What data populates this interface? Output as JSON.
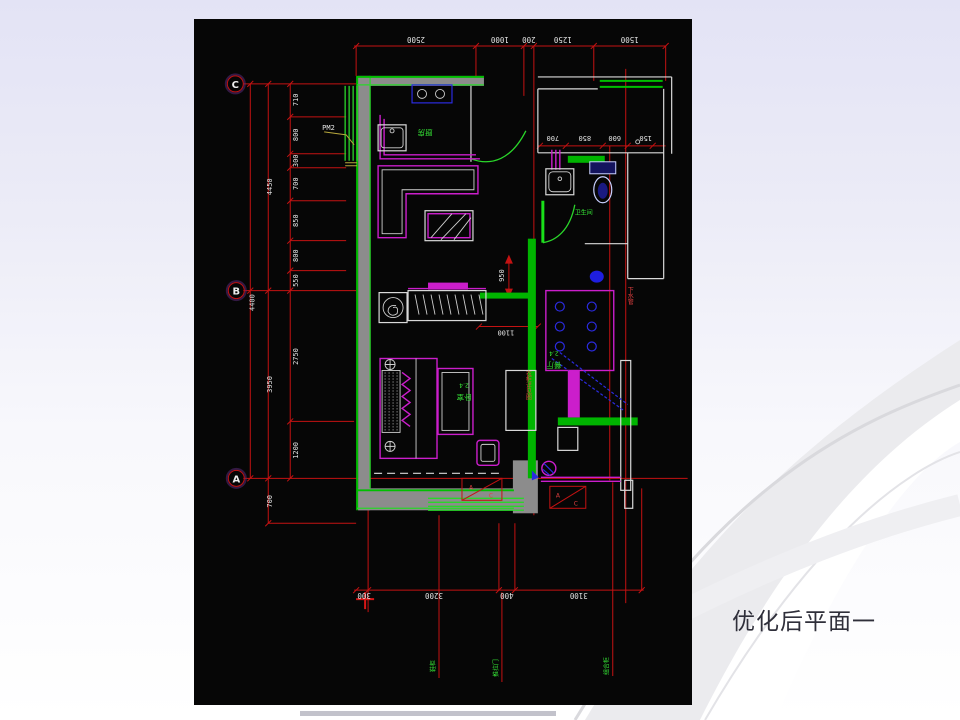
{
  "slide": {
    "title": "优化后平面一",
    "colors": {
      "bg_top": "#e3e3f5",
      "bg_bottom": "#ffffff",
      "swoosh_gray": "#e9e9ed",
      "title_color": "#2f2f3a"
    }
  },
  "cad": {
    "colors": {
      "canvas": "#060606",
      "dim_red": "#c41212",
      "wall_green": "#00bf00",
      "wall_gray": "#8c8c8c",
      "furniture_magenta": "#cb1ecb",
      "appliance_blue": "#2b2bdf",
      "fixture_white": "#d9d9d9",
      "dim_text_white": "#e4e4e4",
      "label_green": "#35e335"
    },
    "grid_bubbles": {
      "c": "C",
      "b": "B",
      "a": "A"
    },
    "dims": {
      "top": [
        "2500",
        "1000",
        "200",
        "1250",
        "1500"
      ],
      "bottom": [
        "300",
        "3200",
        "400",
        "3100"
      ],
      "left_c_to_b": [
        "710",
        "800",
        "300",
        "700",
        "850",
        "800",
        "550"
      ],
      "left_overall_c_b": "4450",
      "left_outer_overall": "4400",
      "left_b_to_a": [
        "2750",
        "1200"
      ],
      "left_overall_b_a": "3950",
      "left_below_a": "700",
      "bath": [
        "700",
        "850",
        "600",
        "150"
      ],
      "interior_vertical": "950",
      "interior_horizontal": "1100"
    },
    "window_tag": "PM2",
    "room_labels": {
      "kitchen": "厨房",
      "bathroom": "卫生间",
      "bedroom_area": "2.4",
      "bedroom": "卧室",
      "dining_area": "2.4",
      "dining": "餐厅"
    },
    "bottom_leaders": [
      "鞋柜",
      "推拉门",
      "组合柜"
    ],
    "notes": {
      "wardrobe_note": "衣柜详见图",
      "pipe_note": "下水管"
    },
    "ac_unit": {
      "letter_a": "A",
      "letter_c": "C"
    }
  }
}
